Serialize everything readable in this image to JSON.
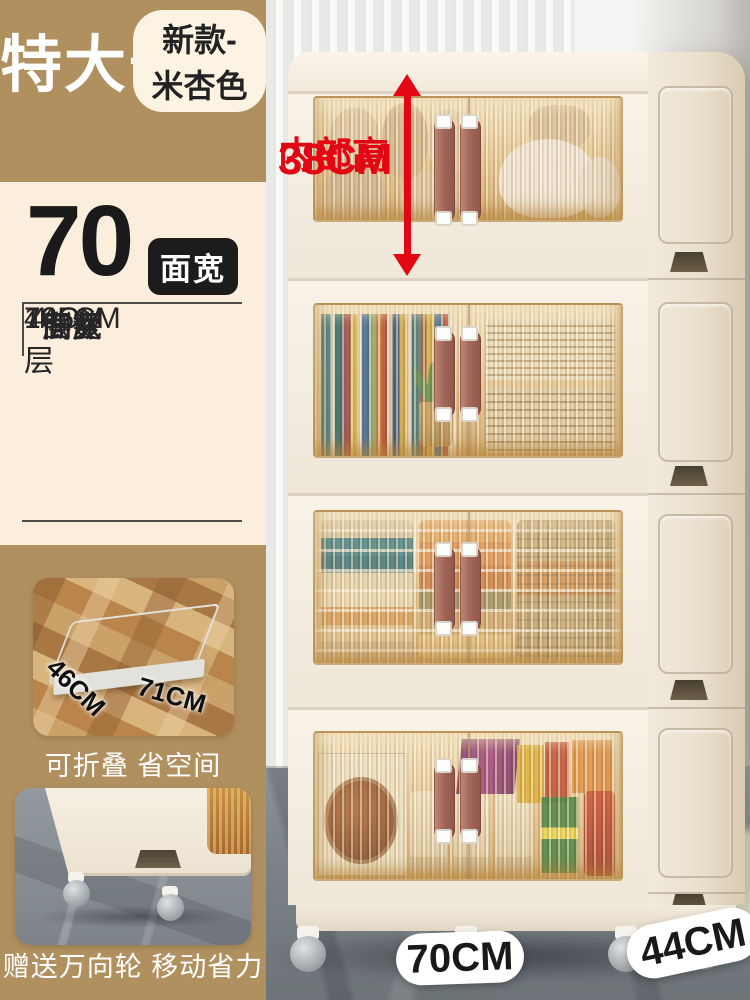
{
  "colors": {
    "sidebar_tan": "#b19060",
    "panel_cream": "#fbeedd",
    "annotation_red": "#e30613",
    "badge_black": "#1c1c1c",
    "cabinet_cream": "#f5eee3",
    "window_amber": "#e2c28e",
    "handle_brown": "#a2685a"
  },
  "sidebar": {
    "size_badge": "特大号",
    "variant_pill": "新款-米杏色",
    "width_number": "70",
    "width_badge": "面宽",
    "spec_rows": [
      {
        "label": "层数",
        "value": "4层"
      },
      {
        "label": "面宽",
        "value": "70CM"
      },
      {
        "label": "侧深",
        "value": "44CM"
      },
      {
        "label": "高度",
        "value": "165CM"
      }
    ],
    "photo1": {
      "caption": "可折叠 省空间",
      "dim_left": "46CM",
      "dim_right": "71CM"
    },
    "photo2": {
      "caption": "赠送万向轮 移动省力"
    }
  },
  "annotation": {
    "line1": "内部高",
    "line2": "38CM"
  },
  "floor_labels": {
    "width": "70CM",
    "depth": "44CM"
  }
}
